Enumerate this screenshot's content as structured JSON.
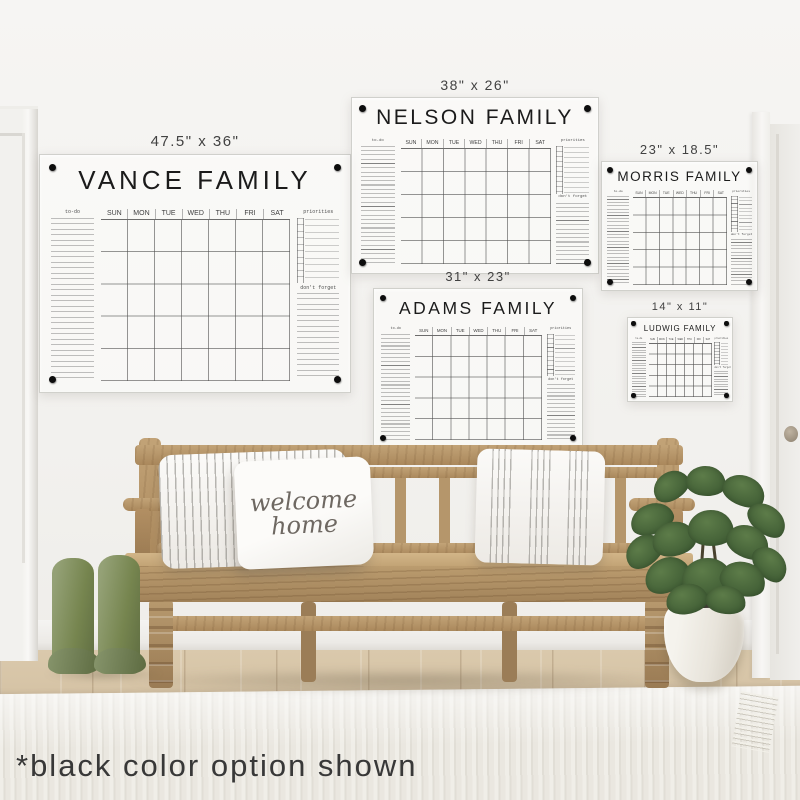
{
  "note": {
    "text": "*black color option shown"
  },
  "labels": {
    "todo": "to-do",
    "priorities": "priorities",
    "dont_forget": "don't forget"
  },
  "days": [
    "SUN",
    "MON",
    "TUE",
    "WED",
    "THU",
    "FRI",
    "SAT"
  ],
  "calendars": [
    {
      "name": "VANCE FAMILY",
      "size": "47.5\" x 36\""
    },
    {
      "name": "NELSON FAMILY",
      "size": "38\" x 26\""
    },
    {
      "name": "MORRIS FAMILY",
      "size": "23\" x 18.5\""
    },
    {
      "name": "ADAMS FAMILY",
      "size": "31\" x 23\""
    },
    {
      "name": "LUDWIG FAMILY",
      "size": "14\" x 11\""
    }
  ],
  "pillow": {
    "line1": "welcome",
    "line2": "home"
  },
  "colors": {
    "calendar_text": "#1b1b1b",
    "mount_dot": "#0d0d0d",
    "wall": "#f2f1ee",
    "bench_wood": "#b3946a",
    "boots_green": "#76854f",
    "plant_green": "#4e6b3d",
    "rug": "#eae7e0"
  }
}
